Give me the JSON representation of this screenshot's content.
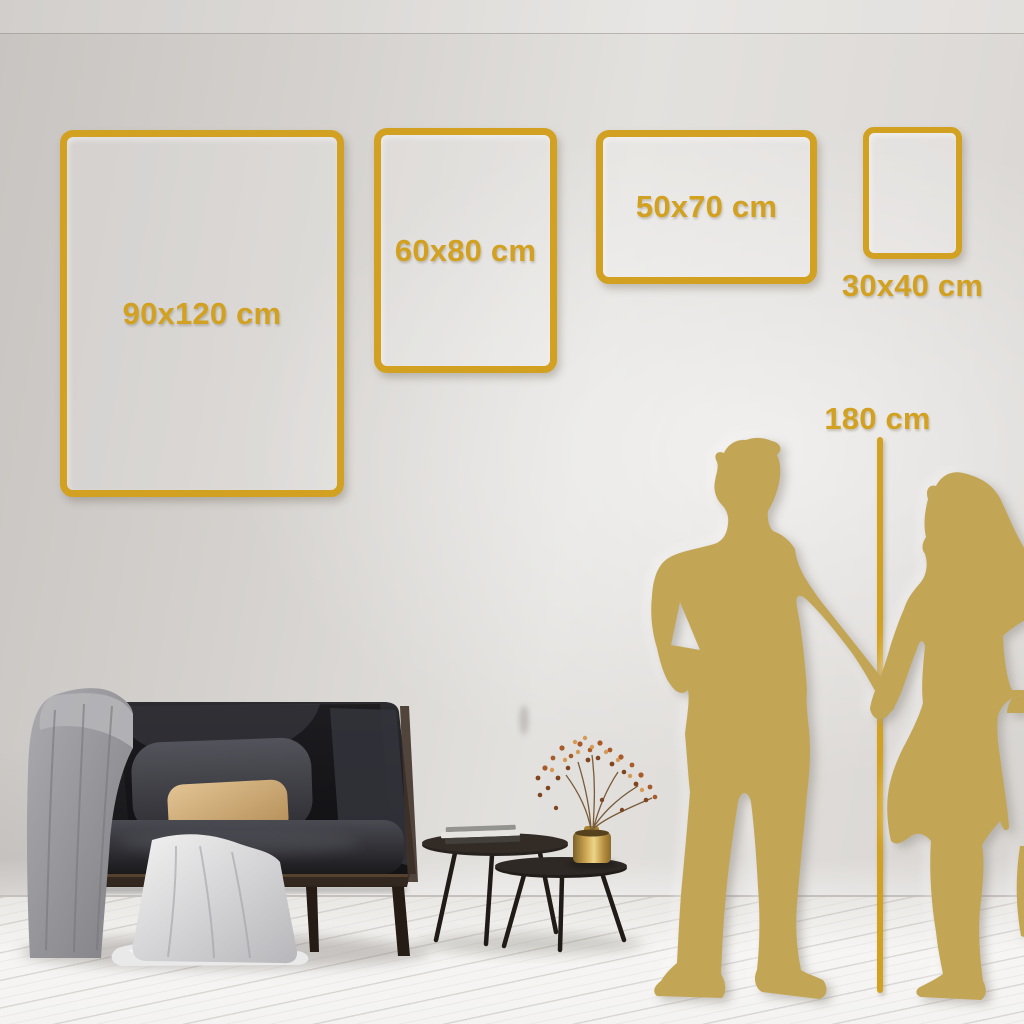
{
  "size_guide": {
    "frames": [
      {
        "name": "frame-90x120",
        "label": "90x120 cm"
      },
      {
        "name": "frame-60x80",
        "label": "60x80 cm"
      },
      {
        "name": "frame-50x70",
        "label": "50x70 cm"
      },
      {
        "name": "frame-30x40",
        "label": "30x40 cm"
      }
    ],
    "height_reference": {
      "label": "180 cm"
    }
  },
  "colors": {
    "accent_gold": "#d2a122",
    "silhouette_gold": "#c3a655",
    "wall_left": "#c8c4c1",
    "wall_center": "#e3e1de",
    "wall_right": "#d7d4d1",
    "floor": "#f4f3f1"
  }
}
